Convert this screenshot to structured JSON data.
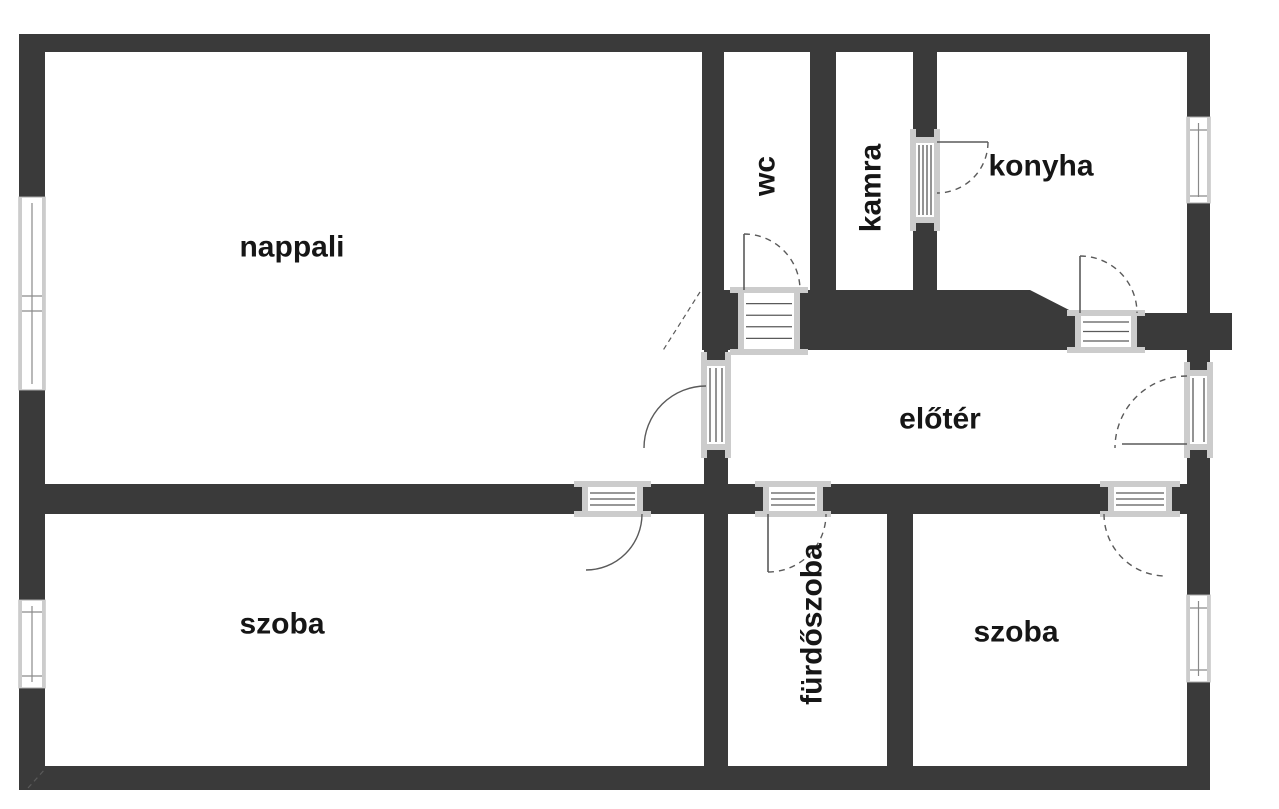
{
  "title": "Lakás alaprajz (floor plan)",
  "colors": {
    "wall": "#3a3a3a",
    "line": "#5a5a5a",
    "glass": "#8a8a8a",
    "sill": "#cccccc",
    "bg": "#ffffff",
    "text": "#161616"
  },
  "rooms": [
    {
      "id": "nappali",
      "label": "nappali",
      "x": 292,
      "y": 247,
      "rotate": false
    },
    {
      "id": "wc",
      "label": "wc",
      "x": 765,
      "y": 176,
      "rotate": true
    },
    {
      "id": "kamra",
      "label": "kamra",
      "x": 871,
      "y": 188,
      "rotate": true
    },
    {
      "id": "konyha",
      "label": "konyha",
      "x": 1041,
      "y": 166,
      "rotate": false
    },
    {
      "id": "eloter",
      "label": "előtér",
      "x": 940,
      "y": 419,
      "rotate": false
    },
    {
      "id": "szoba-bal",
      "label": "szoba",
      "x": 282,
      "y": 624,
      "rotate": false
    },
    {
      "id": "furdoszoba",
      "label": "fürdőszoba",
      "x": 812,
      "y": 624,
      "rotate": true
    },
    {
      "id": "szoba-jobb",
      "label": "szoba",
      "x": 1016,
      "y": 632,
      "rotate": false
    }
  ],
  "plan": {
    "width": 1279,
    "height": 809,
    "walls": [
      {
        "name": "top-wall",
        "x": 19,
        "y": 34,
        "w": 1191,
        "h": 18
      },
      {
        "name": "left-wall-upper",
        "x": 19,
        "y": 34,
        "w": 26,
        "h": 163
      },
      {
        "name": "left-wall-mid",
        "x": 19,
        "y": 390,
        "w": 26,
        "h": 210
      },
      {
        "name": "left-wall-lower",
        "x": 19,
        "y": 688,
        "w": 26,
        "h": 78
      },
      {
        "name": "bottom-wall",
        "x": 19,
        "y": 766,
        "w": 1191,
        "h": 24
      },
      {
        "name": "right-wall-a",
        "x": 1187,
        "y": 34,
        "w": 23,
        "h": 83
      },
      {
        "name": "right-wall-b",
        "x": 1187,
        "y": 203,
        "w": 23,
        "h": 167
      },
      {
        "name": "right-wall-c",
        "x": 1187,
        "y": 450,
        "w": 23,
        "h": 145
      },
      {
        "name": "right-wall-d",
        "x": 1187,
        "y": 682,
        "w": 23,
        "h": 84
      },
      {
        "name": "wall-nappali-wc",
        "x": 702,
        "y": 52,
        "w": 22,
        "h": 238
      },
      {
        "name": "wall-wc-kamra",
        "x": 810,
        "y": 52,
        "w": 26,
        "h": 238
      },
      {
        "name": "wall-kamra-konyha-top",
        "x": 913,
        "y": 52,
        "w": 24,
        "h": 85
      },
      {
        "name": "wall-kamra-konyha-bot",
        "x": 913,
        "y": 223,
        "w": 24,
        "h": 67
      },
      {
        "name": "center-band",
        "x": 702,
        "y": 290,
        "w": 328,
        "h": 60
      },
      {
        "name": "center-band-right",
        "x": 1137,
        "y": 313,
        "w": 95,
        "h": 37
      },
      {
        "name": "wall-above-nappali-door",
        "x": 704,
        "y": 350,
        "w": 24,
        "h": 10
      },
      {
        "name": "wall-below-nappali-door",
        "x": 704,
        "y": 450,
        "w": 24,
        "h": 34
      },
      {
        "name": "middle-wall-left",
        "x": 45,
        "y": 484,
        "w": 537,
        "h": 30
      },
      {
        "name": "middle-wall-seg2",
        "x": 643,
        "y": 484,
        "w": 120,
        "h": 30
      },
      {
        "name": "middle-wall-seg3",
        "x": 823,
        "y": 484,
        "w": 285,
        "h": 30
      },
      {
        "name": "middle-wall-seg4",
        "x": 1172,
        "y": 484,
        "w": 38,
        "h": 30
      },
      {
        "name": "wall-furdo-left",
        "x": 704,
        "y": 514,
        "w": 24,
        "h": 252
      },
      {
        "name": "wall-furdo-right",
        "x": 887,
        "y": 514,
        "w": 26,
        "h": 252
      }
    ],
    "polygons": [
      {
        "name": "konyha-diagonal-wall",
        "points": "1030,290 1075,313 1075,350 1030,350"
      }
    ],
    "windows": [
      {
        "name": "window-nappali-left",
        "x": 19,
        "y": 197,
        "w": 26,
        "h": 193,
        "ticks": [
          296,
          311
        ]
      },
      {
        "name": "window-szoba-left",
        "x": 19,
        "y": 600,
        "w": 26,
        "h": 88,
        "ticks": [
          612,
          676
        ]
      },
      {
        "name": "window-konyha-right",
        "x": 1187,
        "y": 117,
        "w": 23,
        "h": 86,
        "ticks": [
          130,
          196
        ]
      },
      {
        "name": "window-szoba-right",
        "x": 1187,
        "y": 595,
        "w": 23,
        "h": 87,
        "ticks": [
          608,
          670
        ]
      }
    ],
    "door_openings": [
      {
        "name": "door-wc",
        "x": 738,
        "y": 290,
        "w": 62,
        "h": 62,
        "dir": "h",
        "stripes": 4
      },
      {
        "name": "door-kamra",
        "x": 913,
        "y": 137,
        "w": 24,
        "h": 86,
        "dir": "v",
        "stripes": 4
      },
      {
        "name": "door-konyha",
        "x": 1075,
        "y": 313,
        "w": 62,
        "h": 37,
        "dir": "h",
        "stripes": 3
      },
      {
        "name": "door-nappali",
        "x": 704,
        "y": 360,
        "w": 24,
        "h": 90,
        "dir": "v",
        "stripes": 3
      },
      {
        "name": "door-szoba-bal",
        "x": 582,
        "y": 484,
        "w": 61,
        "h": 30,
        "dir": "h",
        "stripes": 3
      },
      {
        "name": "door-furdoszoba",
        "x": 763,
        "y": 484,
        "w": 60,
        "h": 30,
        "dir": "h",
        "stripes": 3
      },
      {
        "name": "door-szoba-jobb",
        "x": 1108,
        "y": 484,
        "w": 64,
        "h": 30,
        "dir": "h",
        "stripes": 3
      },
      {
        "name": "door-bejarat",
        "x": 1187,
        "y": 370,
        "w": 23,
        "h": 80,
        "dir": "v",
        "stripes": 2
      }
    ],
    "swing_arcs": [
      {
        "name": "arc-wc",
        "d": "M744,234 A56,56 0 0 1 800,290",
        "dashed": true
      },
      {
        "name": "arc-kamra",
        "d": "M988,142 A51,51 0 0 1 937,193",
        "dashed": true
      },
      {
        "name": "arc-konyha",
        "d": "M1080,256 A57,57 0 0 1 1137,313",
        "dashed": true
      },
      {
        "name": "arc-nappali",
        "d": "M644,448 A62,62 0 0 1 706,386",
        "dashed": false
      },
      {
        "name": "arc-szoba-bal",
        "d": "M586,570 A56,56 0 0 0 642,514",
        "dashed": false
      },
      {
        "name": "arc-furdoszoba",
        "d": "M768,572 A58,58 0 0 0 826,514",
        "dashed": true
      },
      {
        "name": "arc-szoba-jobb",
        "d": "M1104,514 A62,62 0 0 0 1166,576",
        "dashed": true
      },
      {
        "name": "arc-bejarat",
        "d": "M1187,376 A72,72 0 0 0 1115,448",
        "dashed": true
      }
    ],
    "door_leaves": [
      {
        "name": "leaf-wc",
        "x1": 744,
        "y1": 234,
        "x2": 744,
        "y2": 290
      },
      {
        "name": "leaf-kamra",
        "x1": 937,
        "y1": 142,
        "x2": 988,
        "y2": 142
      },
      {
        "name": "leaf-konyha",
        "x1": 1080,
        "y1": 256,
        "x2": 1080,
        "y2": 313
      },
      {
        "name": "leaf-furdoszoba",
        "x1": 768,
        "y1": 514,
        "x2": 768,
        "y2": 572
      },
      {
        "name": "leaf-bejarat",
        "x1": 1122,
        "y1": 444,
        "x2": 1187,
        "y2": 444
      }
    ],
    "dashed_lines": [
      {
        "name": "corner-dash-center",
        "x1": 700,
        "y1": 292,
        "x2": 662,
        "y2": 352
      },
      {
        "name": "corner-dash-bottom-left",
        "x1": 28,
        "y1": 788,
        "x2": 46,
        "y2": 768
      }
    ]
  }
}
